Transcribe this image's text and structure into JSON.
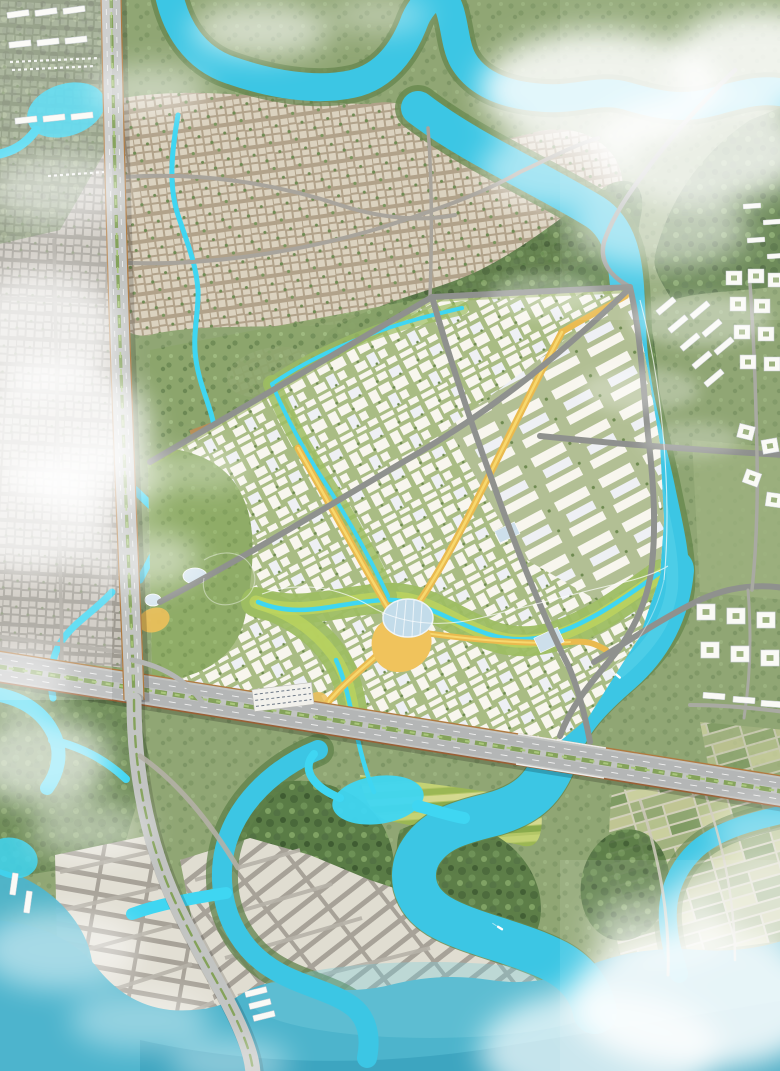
{
  "meta": {
    "title": "Riverfront new-town masterplan — aerial rendering",
    "view": "top-down aerial render, no visible text labels",
    "canvas": {
      "width": 780,
      "height": 1071
    }
  },
  "palette": {
    "base_green": "#96a87e",
    "river": "#3cc6e4",
    "river_highlight": "#63d6ec",
    "stream": "#3fd6f2",
    "sea": "#4db4cc",
    "sea_deep": "#2e95b4",
    "park_green": "#9dbd62",
    "park_bright": "#bcd45e",
    "forest": "#5a7c46",
    "riparian": "#67884e",
    "street_sage": "#a9bc84",
    "street_sage_alt": "#b2bf94",
    "block_white": "#f8f6ee",
    "block_cool": "#eef0f4",
    "beige_fabric": "#dbd2bf",
    "beige_gap": "#b1a28a",
    "gray_fabric": "#c8c4bb",
    "gray_gap": "#9e9a91",
    "road": "#8f918e",
    "road_minor": "#a8a49c",
    "highway": "#c2c4c2",
    "highway_lane": "#b4b6b6",
    "highway_edge": "#b07a40",
    "median_green": "#84a25a",
    "median_light": "#a9c77a",
    "boulevard": "#eaba4e",
    "boulevard_core": "#f7d86e",
    "plaza": "#f0c35c",
    "dome": "#c3dcea",
    "farmland": "#a3b380",
    "paddies": "#b5c866",
    "plot_pale": "#e2dfd4",
    "plot_gap": "#a7a298",
    "cloud": "#ffffff",
    "boat": "#ffffff"
  },
  "features": {
    "main_river": "Meandering turquoise river framing the plan east and south",
    "upper_river": "Upper river arm across the top of the plan",
    "estuary": "Wide estuary water body along the bottom edge",
    "central_district": "New-town core: white blocks on sage-green streets, tilted grid",
    "northeast_slabs": "Larger white slab blocks along the river bank",
    "green_corridor": "Winding riparian park corridor with bright stream",
    "orange_boulevards": "Amber pedestrian boulevards converging on central plaza",
    "central_plaza": "Amber plaza with striped dome pavilion",
    "west_park": "Park band with crossing streams and oval pavilions",
    "ns_highway": "North–south highway with planted median",
    "ew_expressway": "East–west expressway crossing the plan south edge",
    "arc_road": "Curved arterial sweeping south through coastal plots",
    "village_fabric": "Existing beige village fabric (north)",
    "west_city_fabric": "Faded existing city fabric (west strip)",
    "east_bank_campus": "White courtyard and bar buildings on east bank",
    "industrial_sheds": "White shed rows, top-left corner",
    "sawtooth_hall": "Saw-tooth roofed market hall near expressway",
    "farmland": "Farmland patchwork, south-east",
    "rice_paddies": "Bright paddies south of expressway",
    "coastal_plots": "Pale aquaculture plots fanning along arc road",
    "mangroves": "Dense riverine forest inside river loops",
    "boats": "Three small boats on the river",
    "clouds": "White cloud cover at corners and over west strip"
  }
}
